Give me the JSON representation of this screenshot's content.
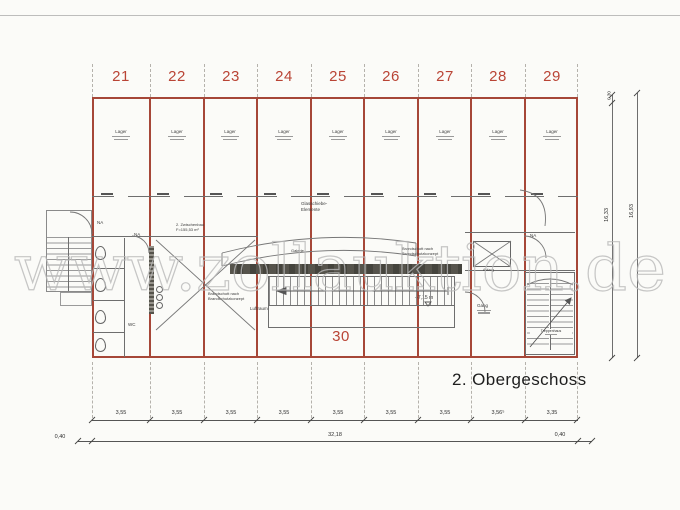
{
  "page": {
    "watermark": "www.zollauktion.de",
    "floor_label": "2. Obergeschoss"
  },
  "rooms": {
    "numbers": [
      "21",
      "22",
      "23",
      "24",
      "25",
      "26",
      "27",
      "28",
      "29"
    ],
    "hall_number": "30",
    "unit_label": "Lager"
  },
  "labels": {
    "glass1": "Glasschiebe-",
    "glass2": "Elemente",
    "zwischenbau1": "2. Zwischenbau",
    "zwischenbau2": "F=155,53 m²",
    "brand1": "Brandschott nach",
    "brand2": "Brandschutzkonzept",
    "luftraum": "Luftraum",
    "galerie": "Galerie",
    "level": "+7,15 m",
    "na": "NA",
    "wc": "WC",
    "gang": "Gang",
    "treppenhaus": "Treppenhaus",
    "aufzug": "Aufzug"
  },
  "dimensions": {
    "bottom_segments": [
      "3,55",
      "3,55",
      "3,55",
      "3,55",
      "3,55",
      "3,55",
      "3,55",
      "3,56⁵",
      "3,35"
    ],
    "bottom_margin_left": "0,40",
    "bottom_total": "32,18",
    "bottom_margin_right": "0,40",
    "right_small_top": "0,30",
    "right_inner": "16,33",
    "right_outer": "16,93"
  },
  "colors": {
    "plan_red": "#a64738",
    "number_red": "#b94435",
    "line_gray": "#6e6e6e",
    "dark_band": "#4f4d45",
    "watermark_gray": "#b9b9b9"
  }
}
